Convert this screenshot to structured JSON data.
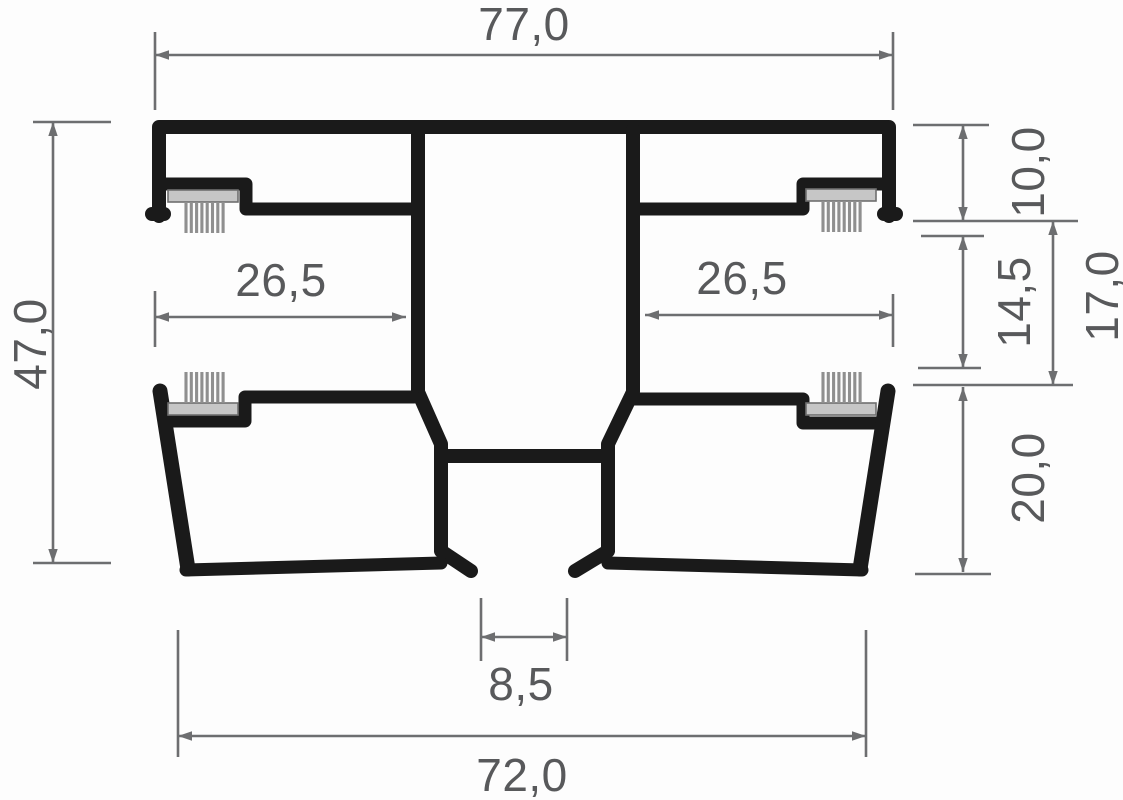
{
  "drawing": {
    "type": "profile-cross-section-technical-drawing",
    "decimal_separator": ",",
    "dims": {
      "overall_width_top": "77,0",
      "overall_height": "47,0",
      "left_rebate_width": "26,5",
      "right_rebate_width": "26,5",
      "top_step_height": "10,0",
      "mid_step_height": "14,5",
      "mid_total_height": "17,0",
      "bottom_chamber_height": "20,0",
      "bottom_slot_width": "8,5",
      "overall_width_bottom": "72,0"
    },
    "colors": {
      "profile_outline": "#1a1a1a",
      "dimension_lines": "#6d6e70",
      "dimension_text": "#58595b",
      "brush_bristles": "#8f8f8f",
      "brush_base": "#c6c6c6",
      "background": "#fdfdfd"
    }
  }
}
